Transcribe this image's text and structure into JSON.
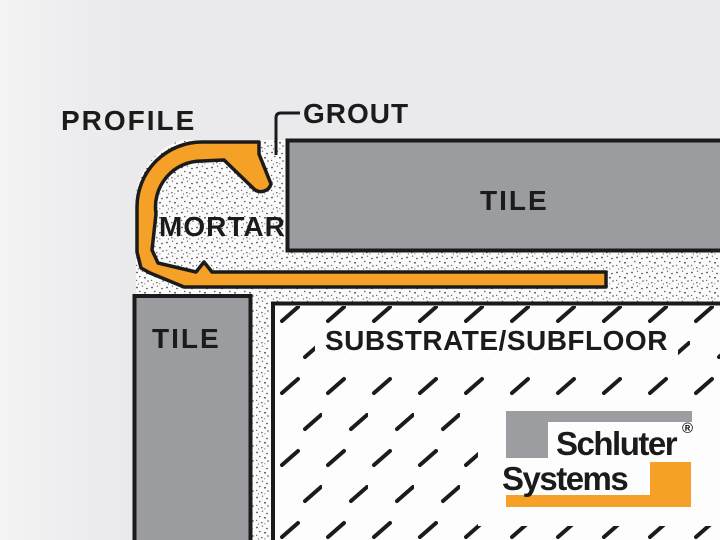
{
  "diagram": {
    "labels": {
      "profile": "PROFILE",
      "grout": "GROUT",
      "mortar": "MORTAR",
      "tile_top": "TILE",
      "tile_left": "TILE",
      "substrate": "SUBSTRATE/SUBFLOOR"
    },
    "colors": {
      "background": "#EAEAEC",
      "profile_orange": "#F5A027",
      "tile_gray": "#9A9CA0",
      "outline_black": "#1B1B1B",
      "substrate_white": "#FDFDFD",
      "mortar_stipple_dot": "#4A4A4A"
    }
  },
  "logo": {
    "brand_line1": "Schluter",
    "brand_line2": "Systems",
    "registered_mark": "®",
    "colors": {
      "bracket_gray": "#9C9DA1",
      "bracket_orange": "#F5A027"
    }
  }
}
